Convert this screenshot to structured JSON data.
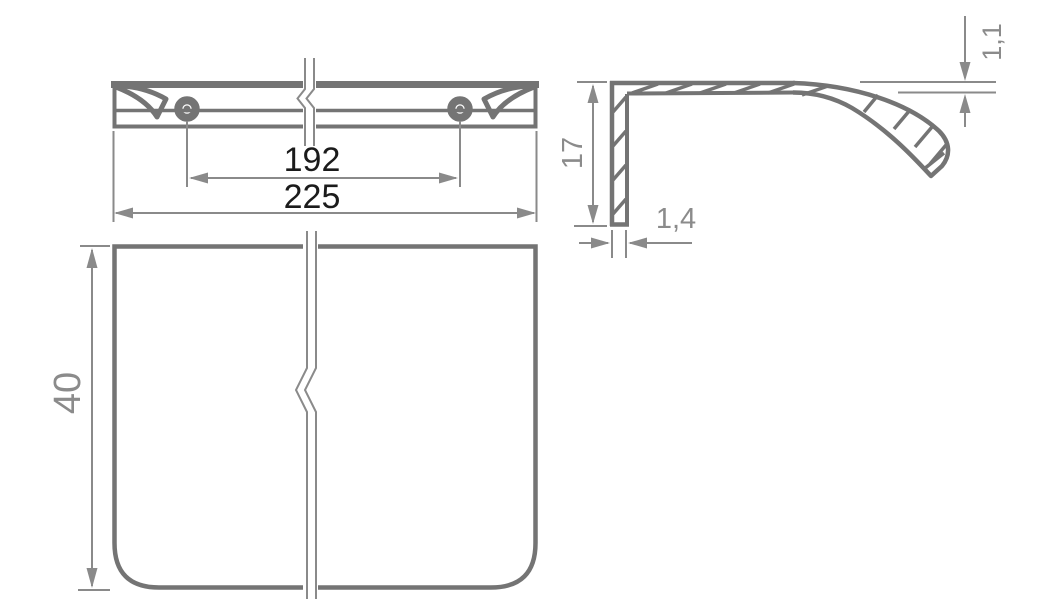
{
  "colors": {
    "background": "#ffffff",
    "line_gray": "#747474",
    "dim_gray": "#8a8a8a",
    "text_black": "#1b1b1b",
    "text_gray": "#8b8b8b"
  },
  "views": {
    "top_view": {
      "dim_hole_spacing": "192",
      "dim_overall_width": "225"
    },
    "side_section_view": {
      "dim_lip_thickness": "1,1",
      "dim_height": "17",
      "dim_wall_thickness": "1,4"
    },
    "front_view": {
      "dim_height": "40"
    }
  }
}
